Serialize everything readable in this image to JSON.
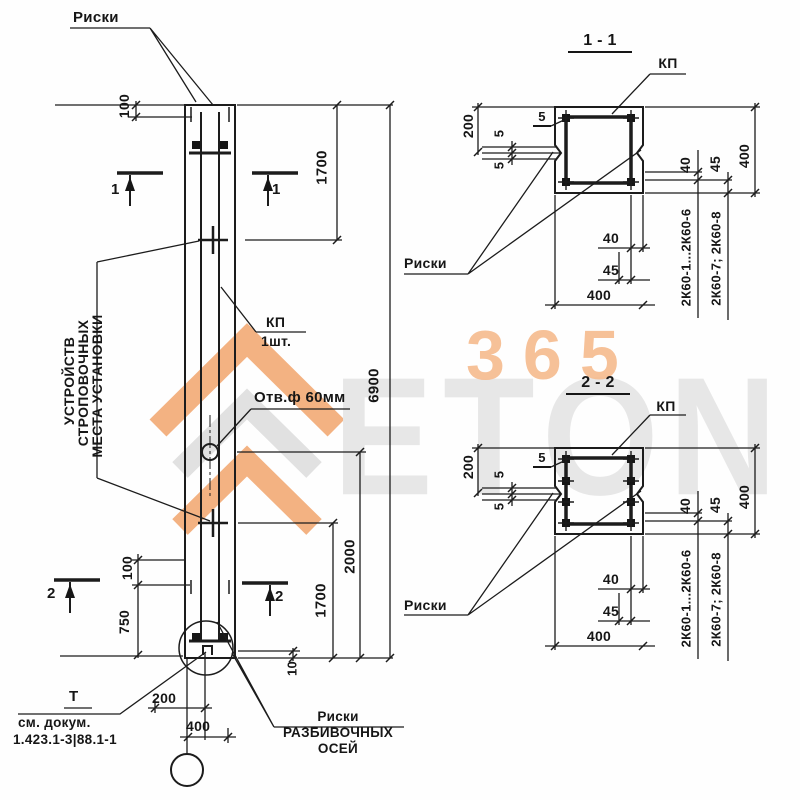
{
  "watermark": {
    "logo_text": "ETON",
    "number": "365"
  },
  "elevation": {
    "marks_top": "Риски",
    "dim_top_mark_offset": "100",
    "section_cut_1": "1",
    "dim_upper_1700": "1700",
    "kp_label": "КП",
    "kp_qty": "1шт.",
    "strop_lines": [
      "МЕСТА УСТАНОВКИ",
      "СТРОПОВОЧНЫХ",
      "УСТРОЙСТВ"
    ],
    "hole_callout": "Отв.ф 60мм",
    "dim_total": "6900",
    "dim_2000": "2000",
    "dim_lower_1700": "1700",
    "dim_bottom_mark_offset": "100",
    "dim_750": "750",
    "dim_10": "10",
    "section_cut_2": "2",
    "end_face_mark": "Т",
    "doc_line1": "см. докум.",
    "doc_line2": "1.423.1-3|88.1-1",
    "dim_200": "200",
    "dim_400": "400",
    "axes_lines": [
      "Риски",
      "РАЗБИВОЧНЫХ",
      "ОСЕЙ"
    ]
  },
  "sections": [
    {
      "title": "1 - 1",
      "kp": "КП",
      "marks": "Риски",
      "dim_200": "200",
      "dim_5_upper": "5",
      "dim_5_lower": "5",
      "dim_5_cover": "5",
      "dim_40_right": "40",
      "dim_45_right": "45",
      "dim_400_right": "400",
      "dim_40_bottom": "40",
      "dim_45_bottom": "45",
      "dim_400_bottom": "400",
      "series_range_1": "2К60-1...2К60-6",
      "series_range_2": "2К60-7; 2К60-8"
    },
    {
      "title": "2 - 2",
      "kp": "КП",
      "marks": "Риски",
      "dim_200": "200",
      "dim_5_upper": "5",
      "dim_5_lower": "5",
      "dim_5_cover": "5",
      "dim_40_right": "40",
      "dim_45_right": "45",
      "dim_400_right": "400",
      "dim_40_bottom": "40",
      "dim_45_bottom": "45",
      "dim_400_bottom": "400",
      "series_range_1": "2К60-1...2К60-6",
      "series_range_2": "2К60-7; 2К60-8"
    }
  ]
}
